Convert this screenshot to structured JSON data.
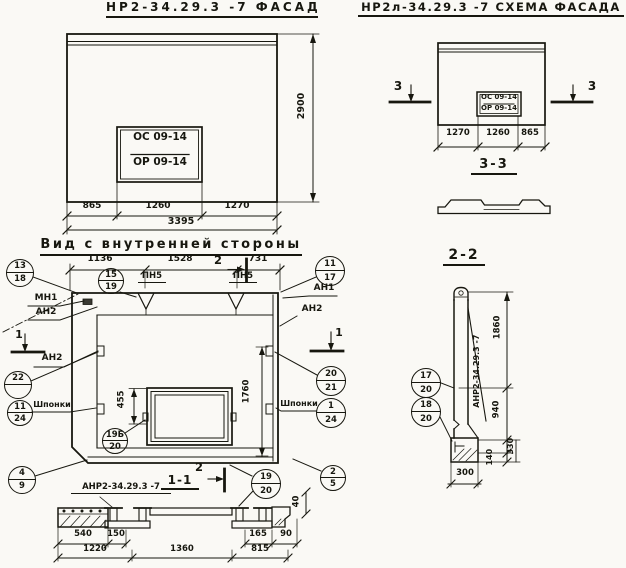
{
  "facade": {
    "title": "НР2-34.29.3 -7 ФАСАД",
    "stamp": {
      "line1": "ОС 09-14",
      "line2": "ОР 09-14"
    },
    "dim_height": "2900",
    "dims_bottom": [
      "865",
      "1260",
      "1270"
    ],
    "dim_total": "3395"
  },
  "scheme": {
    "title": "НР2л-34.29.3 -7 СХЕМА ФАСАДА",
    "stamp": {
      "line1": "ОС 09-14",
      "line2": "ОР 09-14"
    },
    "dims_bottom": [
      "1270",
      "1260",
      "865"
    ],
    "cut3": "3",
    "section33_title": "3-3"
  },
  "inner": {
    "title": "Вид с внутренней стороны",
    "dims_top": [
      "1136",
      "1528",
      "731"
    ],
    "cut2": "2",
    "cut1": "1",
    "pn5": "ПН5",
    "mn1": "МН1",
    "an1": "АН1",
    "an2": "АН2",
    "shponki": "Шпонки",
    "dim_455": "455",
    "dim_1760": "1760",
    "dim_40": "40",
    "section11_title": "1-1",
    "anr_label": "АНР2-34.29.3 -7",
    "dims_b1": [
      "540",
      "150",
      "165",
      "90"
    ],
    "dims_b2": [
      "1220",
      "1360",
      "815"
    ]
  },
  "section22": {
    "title": "2-2",
    "anr_label": "АНР2-34.29.3 -7",
    "dim_1860": "1860",
    "dim_940": "940",
    "dim_330": "330",
    "dim_140": "140",
    "dim_300": "300"
  },
  "callouts": [
    {
      "top": "13",
      "bottom": "18"
    },
    {
      "top": "15",
      "bottom": "19"
    },
    {
      "top": "11",
      "bottom": "17"
    },
    {
      "top": "22",
      "bottom": ""
    },
    {
      "top": "11",
      "bottom": "24"
    },
    {
      "top": "19Б",
      "bottom": "20"
    },
    {
      "top": "20",
      "bottom": "21"
    },
    {
      "top": "1",
      "bottom": "24"
    },
    {
      "top": "2",
      "bottom": "5"
    },
    {
      "top": "4",
      "bottom": "9"
    },
    {
      "top": "19",
      "bottom": "20"
    },
    {
      "top": "17",
      "bottom": "20"
    },
    {
      "top": "18",
      "bottom": "20"
    }
  ],
  "colors": {
    "ink": "#17170f",
    "paper": "#faf9f5"
  }
}
